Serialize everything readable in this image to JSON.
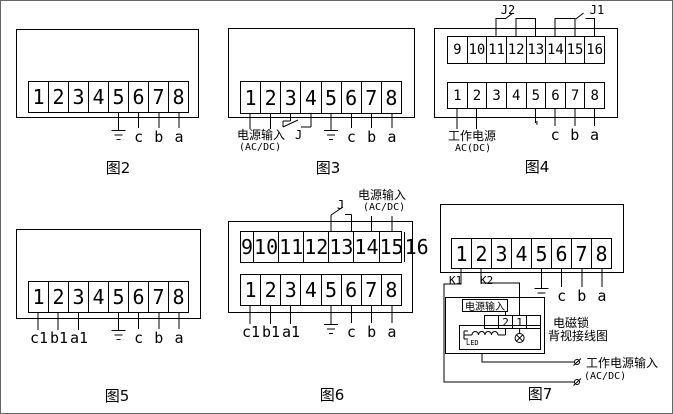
{
  "page": {
    "background": "#ffffff",
    "line_color": "#000000"
  },
  "figures": {
    "fig2": {
      "caption": "图2",
      "terminals": [
        "1",
        "2",
        "3",
        "4",
        "5",
        "6",
        "7",
        "8"
      ],
      "pins": {
        "c": "c",
        "b": "b",
        "a": "a"
      }
    },
    "fig3": {
      "caption": "图3",
      "terminals": [
        "1",
        "2",
        "3",
        "4",
        "5",
        "6",
        "7",
        "8"
      ],
      "power": {
        "line1": "电源输入",
        "line2": "(AC/DC)"
      },
      "relay": "J",
      "pins": {
        "c": "c",
        "b": "b",
        "a": "a"
      }
    },
    "fig4": {
      "caption": "图4",
      "top_terminals": [
        "9",
        "10",
        "11",
        "12",
        "13",
        "14",
        "15",
        "16"
      ],
      "bottom_terminals": [
        "1",
        "2",
        "3",
        "4",
        "5",
        "6",
        "7",
        "8"
      ],
      "relays": {
        "j2": "J2",
        "j1": "J1"
      },
      "power": {
        "line1": "工作电源",
        "line2": "AC(DC)"
      },
      "tick": "'",
      "pins": {
        "c": "c",
        "b": "b",
        "a": "a"
      }
    },
    "fig5": {
      "caption": "图5",
      "terminals": [
        "1",
        "2",
        "3",
        "4",
        "5",
        "6",
        "7",
        "8"
      ],
      "pins": {
        "c1": "c1",
        "b1": "b1",
        "a1": "a1",
        "c": "c",
        "b": "b",
        "a": "a"
      }
    },
    "fig6": {
      "caption": "图6",
      "top_terminals": [
        "9",
        "10",
        "11",
        "12",
        "13",
        "14",
        "15",
        "16"
      ],
      "bottom_terminals": [
        "1",
        "2",
        "3",
        "4",
        "5",
        "6",
        "7",
        "8"
      ],
      "relay": "J",
      "power": {
        "line1": "电源输入",
        "line2": "(AC/DC)"
      },
      "pins": {
        "c1": "c1",
        "b1": "b1",
        "a1": "a1",
        "c": "c",
        "b": "b",
        "a": "a"
      }
    },
    "fig7": {
      "caption": "图7",
      "terminals": [
        "1",
        "2",
        "3",
        "4",
        "5",
        "6",
        "7",
        "8"
      ],
      "k1": "K1",
      "k2": "K2",
      "pins": {
        "c": "c",
        "b": "b",
        "a": "a"
      },
      "lock": {
        "power_label": "电源输入",
        "terminals": [
          "",
          "2",
          "1",
          ""
        ],
        "led": "LED",
        "title_line1": "电磁锁",
        "title_line2": "背视接线图"
      },
      "ext_power": {
        "line1": "工作电源输入",
        "line2": "(AC/DC)"
      }
    }
  }
}
